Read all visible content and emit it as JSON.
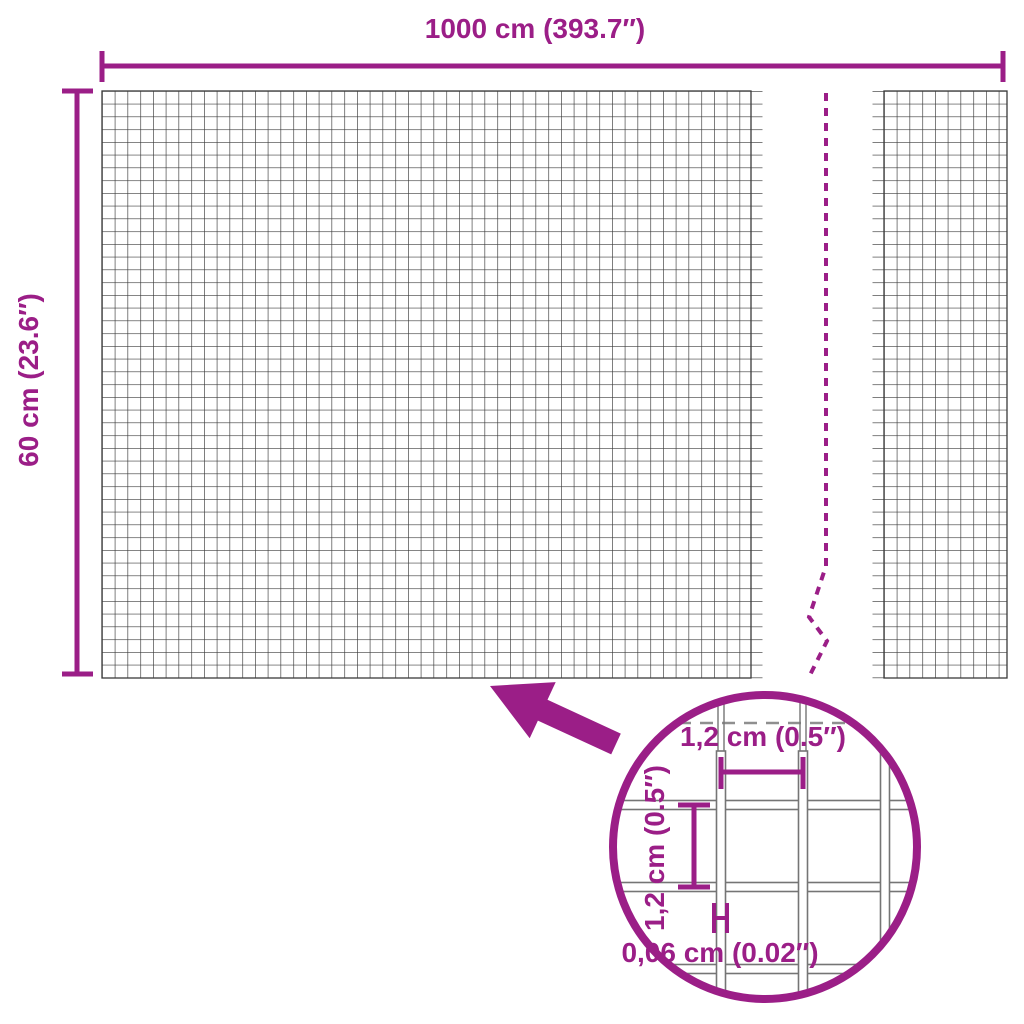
{
  "colors": {
    "accent": "#9b1e87",
    "mesh-line": "#3a3a3a",
    "inset-wire": "#757575",
    "inset-dash": "#8f8f8f",
    "background": "#ffffff"
  },
  "diagram": {
    "width_dimension_label": "1000 cm (393.7″)",
    "height_dimension_label": "60 cm (23.6″)",
    "detail": {
      "cell_width_label": "1,2 cm (0.5″)",
      "cell_height_label": "1,2 cm (0.5″)",
      "wire_thickness_label": "0,06 cm (0.02″)"
    }
  }
}
